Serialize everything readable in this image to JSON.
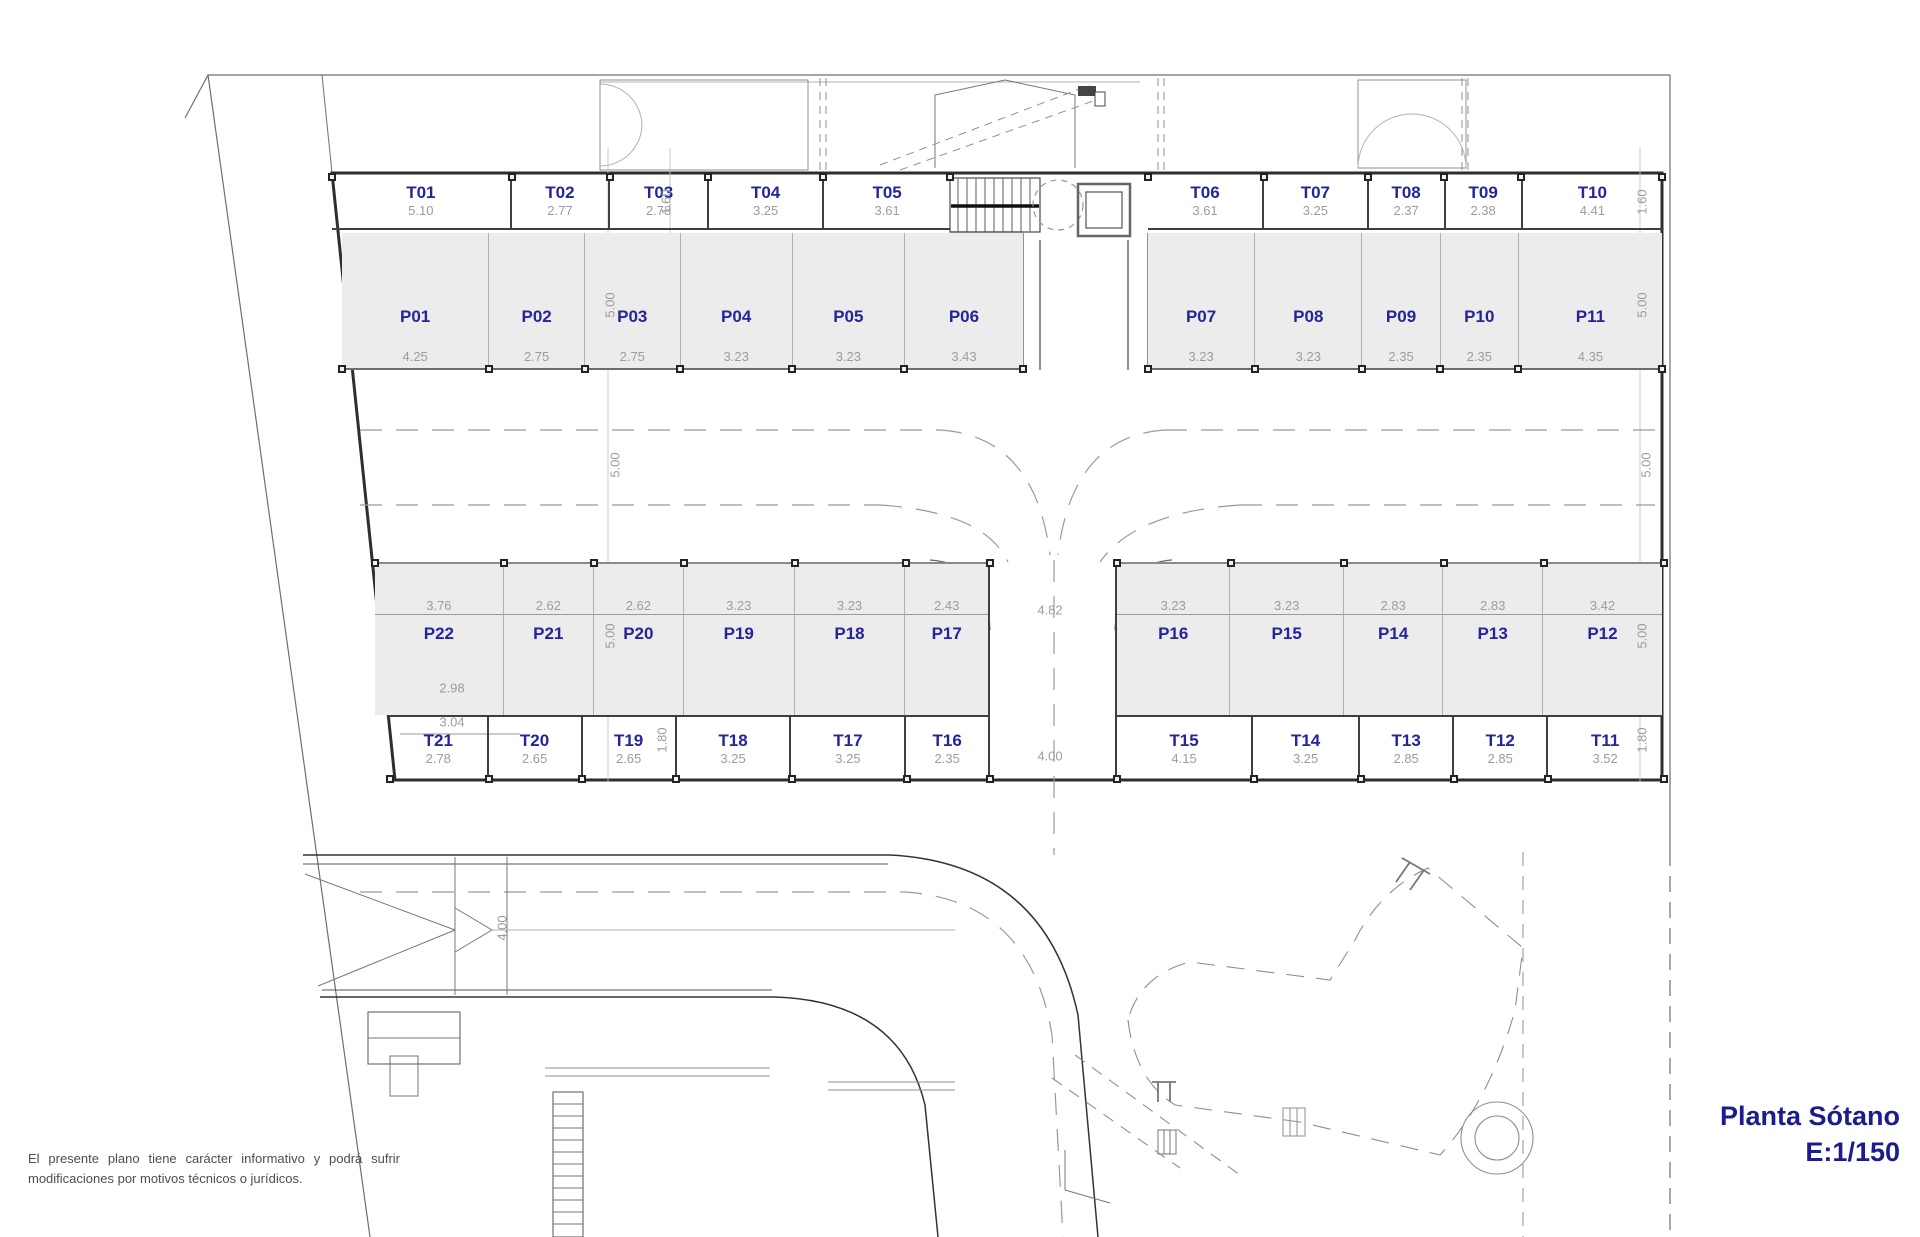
{
  "title": {
    "line1": "Planta Sótano",
    "line2": "E:1/150"
  },
  "disclaimer": "El presente plano tiene carácter informativo y podrá sufrir modificaciones por motivos técnicos o jurídicos.",
  "colors": {
    "label_blue": "#24249c",
    "dim_gray": "#9c9c9c",
    "stall_fill": "#ECECEC",
    "wall": "#2e2e2e"
  },
  "rows": [
    {
      "key": "top_storage_left",
      "type": "t-top",
      "items": [
        {
          "id": "T01",
          "dim": "5.10"
        },
        {
          "id": "T02",
          "dim": "2.77"
        },
        {
          "id": "T03",
          "dim": "2.78"
        },
        {
          "id": "T04",
          "dim": "3.25"
        },
        {
          "id": "T05",
          "dim": "3.61"
        }
      ]
    },
    {
      "key": "top_storage_right",
      "type": "t-top",
      "items": [
        {
          "id": "T06",
          "dim": "3.61"
        },
        {
          "id": "T07",
          "dim": "3.25"
        },
        {
          "id": "T08",
          "dim": "2.37"
        },
        {
          "id": "T09",
          "dim": "2.38"
        },
        {
          "id": "T10",
          "dim": "4.41"
        }
      ]
    },
    {
      "key": "top_parking_left",
      "type": "p-top",
      "items": [
        {
          "id": "P01",
          "dim": "4.25"
        },
        {
          "id": "P02",
          "dim": "2.75"
        },
        {
          "id": "P03",
          "dim": "2.75"
        },
        {
          "id": "P04",
          "dim": "3.23"
        },
        {
          "id": "P05",
          "dim": "3.23"
        },
        {
          "id": "P06",
          "dim": "3.43"
        }
      ]
    },
    {
      "key": "top_parking_right",
      "type": "p-top",
      "items": [
        {
          "id": "P07",
          "dim": "3.23"
        },
        {
          "id": "P08",
          "dim": "3.23"
        },
        {
          "id": "P09",
          "dim": "2.35"
        },
        {
          "id": "P10",
          "dim": "2.35"
        },
        {
          "id": "P11",
          "dim": "4.35"
        }
      ]
    },
    {
      "key": "mid_parking_left",
      "type": "p-mid",
      "items": [
        {
          "id": "P22",
          "dim": "3.76"
        },
        {
          "id": "P21",
          "dim": "2.62"
        },
        {
          "id": "P20",
          "dim": "2.62"
        },
        {
          "id": "P19",
          "dim": "3.23"
        },
        {
          "id": "P18",
          "dim": "3.23"
        },
        {
          "id": "P17",
          "dim": "2.43"
        }
      ]
    },
    {
      "key": "mid_parking_right",
      "type": "p-mid",
      "items": [
        {
          "id": "P16",
          "dim": "3.23"
        },
        {
          "id": "P15",
          "dim": "3.23"
        },
        {
          "id": "P14",
          "dim": "2.83"
        },
        {
          "id": "P13",
          "dim": "2.83"
        },
        {
          "id": "P12",
          "dim": "3.42"
        }
      ]
    },
    {
      "key": "bot_storage_left",
      "type": "t-bot",
      "items": [
        {
          "id": "T21",
          "dim": "2.78"
        },
        {
          "id": "T20",
          "dim": "2.65"
        },
        {
          "id": "T19",
          "dim": "2.65"
        },
        {
          "id": "T18",
          "dim": "3.25"
        },
        {
          "id": "T17",
          "dim": "3.25"
        },
        {
          "id": "T16",
          "dim": "2.35"
        }
      ]
    },
    {
      "key": "bot_storage_right",
      "type": "t-bot",
      "items": [
        {
          "id": "T15",
          "dim": "4.15"
        },
        {
          "id": "T14",
          "dim": "3.25"
        },
        {
          "id": "T13",
          "dim": "2.85"
        },
        {
          "id": "T12",
          "dim": "2.85"
        },
        {
          "id": "T11",
          "dim": "3.52"
        }
      ]
    }
  ],
  "loose_dims": [
    {
      "id": "v160l",
      "text": "1.60",
      "rot": true
    },
    {
      "id": "v160r",
      "text": "1.60",
      "rot": true
    },
    {
      "id": "v500tl",
      "text": "5.00",
      "rot": true
    },
    {
      "id": "v500tr",
      "text": "5.00",
      "rot": true
    },
    {
      "id": "v500al",
      "text": "5.00",
      "rot": true
    },
    {
      "id": "v500ar",
      "text": "5.00",
      "rot": true
    },
    {
      "id": "v500ml",
      "text": "5.00",
      "rot": true
    },
    {
      "id": "v500mr",
      "text": "5.00",
      "rot": true
    },
    {
      "id": "v180l",
      "text": "1.80",
      "rot": true
    },
    {
      "id": "v180r",
      "text": "1.80",
      "rot": true
    },
    {
      "id": "h482",
      "text": "4.82",
      "rot": false
    },
    {
      "id": "h400c",
      "text": "4.00",
      "rot": false
    },
    {
      "id": "h298",
      "text": "2.98",
      "rot": false
    },
    {
      "id": "h304",
      "text": "3.04",
      "rot": false
    },
    {
      "id": "v400ramp",
      "text": "4.00",
      "rot": true
    }
  ]
}
